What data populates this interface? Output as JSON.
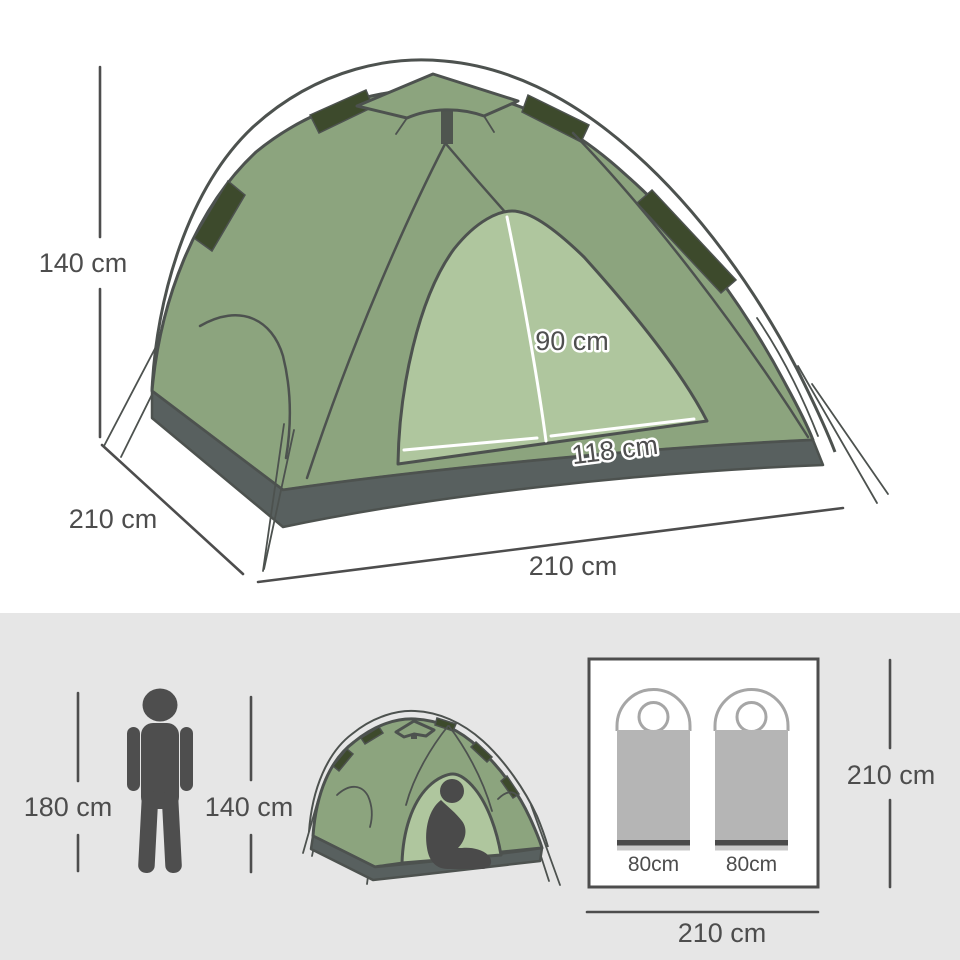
{
  "upper_panel": {
    "background_color": "#ffffff",
    "illustration": "dome-tent-three-quarter-view",
    "labels": {
      "tent_height": "140 cm",
      "tent_depth": "210 cm",
      "tent_width": "210 cm",
      "door_height": "90 cm",
      "door_width": "118 cm"
    }
  },
  "lower_panel": {
    "background_color": "#e6e6e6",
    "illustrations": [
      "standing-person-silhouette",
      "dome-tent-front-view-with-seated-person",
      "tent-floor-plan-with-two-sleeping-bags"
    ],
    "labels": {
      "person_height": "180 cm",
      "tent_peak_height": "140 cm",
      "floor_depth": "210 cm",
      "floor_width": "210 cm"
    },
    "sleeping_bags": [
      {
        "width": "80cm"
      },
      {
        "width": "80cm"
      }
    ]
  },
  "colors": {
    "tent_body_green": "#8ca47e",
    "tent_door_green": "#afc69e",
    "pole_sleeve_dark_green": "#3d4a2c",
    "tent_outline": "#4d524f",
    "groundsheet_gray": "#58605f",
    "silhouette_gray": "#4e4e4e",
    "dimension_text_gray": "#4d4d4d",
    "sleeping_bag_gray": "#b5b5b5",
    "sleeping_bag_outline_gray": "#a6a6a6",
    "lower_panel_background": "#e6e6e6"
  }
}
